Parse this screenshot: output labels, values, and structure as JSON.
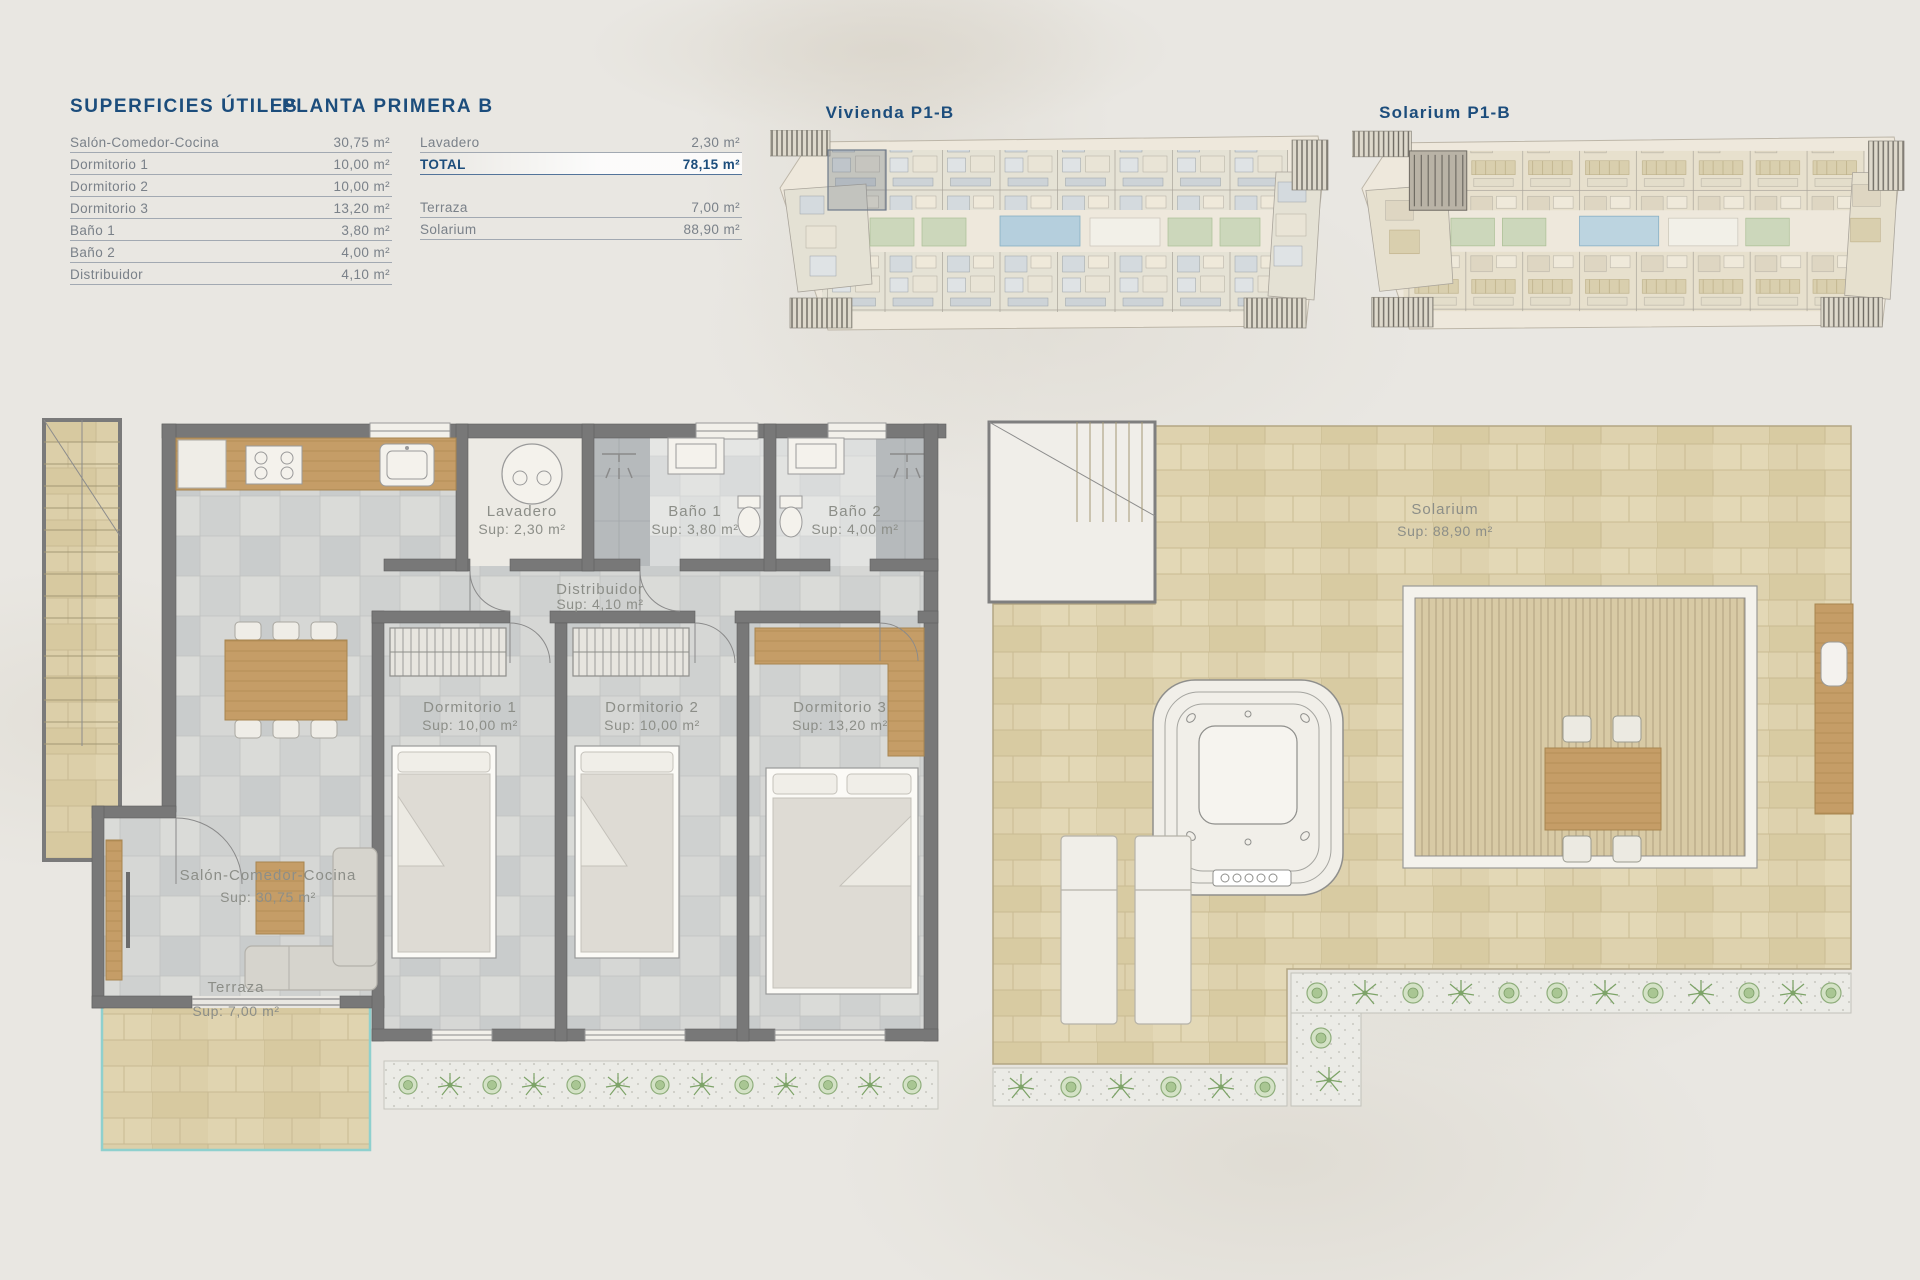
{
  "legend": {
    "title_left": "SUPERFICIES ÚTILES",
    "title_right": "PLANTA PRIMERA B",
    "left_rows": [
      {
        "label": "Salón-Comedor-Cocina",
        "value": "30,75 m²"
      },
      {
        "label": "Dormitorio 1",
        "value": "10,00 m²"
      },
      {
        "label": "Dormitorio 2",
        "value": "10,00 m²"
      },
      {
        "label": "Dormitorio 3",
        "value": "13,20 m²"
      },
      {
        "label": "Baño 1",
        "value": "3,80 m²"
      },
      {
        "label": "Baño 2",
        "value": "4,00 m²"
      },
      {
        "label": "Distribuidor",
        "value": "4,10 m²"
      }
    ],
    "right_rows": [
      {
        "label": "Lavadero",
        "value": "2,30 m²"
      },
      {
        "label": "TOTAL",
        "value": "78,15 m²"
      },
      {
        "label": "Terraza",
        "value": "7,00 m²"
      },
      {
        "label": "Solarium",
        "value": "88,90 m²"
      }
    ]
  },
  "site_plans": {
    "vivienda_title": "Vivienda P1-B",
    "solarium_title": "Solarium P1-B"
  },
  "floor_plan": {
    "lavadero": {
      "name": "Lavadero",
      "sup": "Sup: 2,30 m²"
    },
    "bano1": {
      "name": "Baño 1",
      "sup": "Sup: 3,80 m²"
    },
    "bano2": {
      "name": "Baño 2",
      "sup": "Sup: 4,00 m²"
    },
    "distribuidor": {
      "name": "Distribuidor",
      "sup": "Sup: 4,10 m²"
    },
    "dorm1": {
      "name": "Dormitorio 1",
      "sup": "Sup: 10,00 m²"
    },
    "dorm2": {
      "name": "Dormitorio 2",
      "sup": "Sup: 10,00 m²"
    },
    "dorm3": {
      "name": "Dormitorio 3",
      "sup": "Sup: 13,20 m²"
    },
    "salon": {
      "name": "Salón-Comedor-Cocina",
      "sup": "Sup: 30,75 m²"
    },
    "terraza": {
      "name": "Terraza",
      "sup": "Sup: 7,00 m²"
    }
  },
  "solarium_plan": {
    "name": "Solarium",
    "sup": "Sup: 88,90 m²"
  },
  "colors": {
    "accent_blue": "#1c4d7c",
    "label_gray": "#8c8e88",
    "wall_gray": "#787878",
    "wood": "#c59d67",
    "stone_beige": "#dccfa9",
    "plant_green": "#8fae7c",
    "pool_blue": "#b5cfdd",
    "terrace_edge_teal": "#8fd0ce"
  }
}
